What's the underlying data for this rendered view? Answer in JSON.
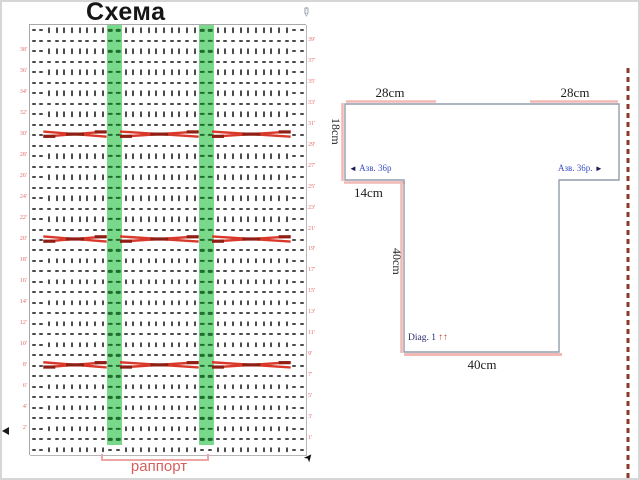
{
  "slide": {
    "title": "Схема"
  },
  "chart": {
    "rapport_label": "раппорт",
    "columns": 36,
    "rows": 41,
    "green_columns": [
      10,
      11,
      22,
      23
    ],
    "edge_dash_columns": [
      0,
      1,
      34,
      35
    ],
    "cable_rows": [
      10,
      20,
      32
    ],
    "cable_sections": [
      [
        2,
        9
      ],
      [
        12,
        21
      ],
      [
        24,
        33
      ]
    ],
    "left_row_numbers": [
      "38'",
      "36'",
      "34'",
      "32'",
      "30'",
      "28'",
      "26'",
      "24'",
      "22'",
      "20'",
      "18'",
      "16'",
      "14'",
      "12'",
      "10'",
      "8'",
      "6'",
      "4'",
      "2'"
    ],
    "right_row_numbers": [
      "39'",
      "37'",
      "35'",
      "33'",
      "31'",
      "29'",
      "27'",
      "25'",
      "23'",
      "21'",
      "19'",
      "17'",
      "15'",
      "13'",
      "11'",
      "9'",
      "7'",
      "5'",
      "3'",
      "1'"
    ],
    "symbols": {
      "knit": "|",
      "purl": "-"
    },
    "colors": {
      "repeat_highlight_green": "#79d98a",
      "green_symbol": "#206b2f",
      "cable_red": "#d8392b",
      "cable_dark_red": "#8f1f15",
      "row_number_red": "#e56a6a",
      "grid_line": "#b7b7b7",
      "stitch_symbol": "#4a4a4a",
      "rapport_pink": "#eda5a5",
      "rapport_text": "#d95f5f"
    }
  },
  "diagram": {
    "top_left_width": "28cm",
    "top_right_width": "28cm",
    "yoke_height": "18cm",
    "shoulder_width": "14cm",
    "body_height": "40cm",
    "bottom_width": "40cm",
    "left_note": {
      "arrow": "◄",
      "text": "Азв. 36р"
    },
    "right_note": {
      "text": "Азв. 36р.",
      "arrow": "►"
    },
    "diag_note": {
      "text": "Diag. 1",
      "arrows": "↑↑"
    },
    "colors": {
      "outline_gray": "#929cae",
      "seam_pink": "#f2b9b4",
      "note_blue": "#3d4fc4",
      "diag_navy": "#2a2a6e",
      "divider_brown": "#8a3a28"
    }
  },
  "icons": {
    "pencil": "✎",
    "cursor": "➤"
  }
}
